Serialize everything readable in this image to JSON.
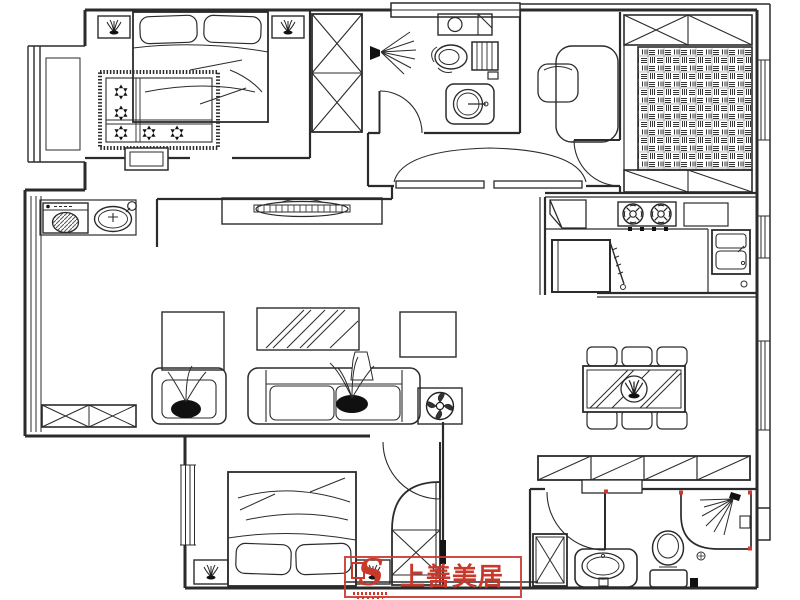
{
  "title": "apartment-floor-plan",
  "watermark": {
    "brand": "上善美居",
    "logo_letter": "S",
    "color": "#c8392c"
  },
  "plan": {
    "background": "#ffffff",
    "line_color": "#2b2b2b",
    "accent_red": "#cf3a30",
    "rooms": [
      {
        "id": "master-bedroom",
        "items": [
          "double-bed",
          "two-pillows",
          "nightstand-with-plant-left",
          "nightstand-with-plant-right",
          "star-pattern-rug",
          "bay-window",
          "dressing-stool",
          "door-opening"
        ]
      },
      {
        "id": "hall-closet",
        "items": [
          "wardrobe-two-x-sections"
        ]
      },
      {
        "id": "bathroom-top",
        "items": [
          "top-window",
          "hand-basin",
          "toilet",
          "round-pedestal-basin",
          "shower-head-spray",
          "swing-door"
        ]
      },
      {
        "id": "entry-foyer",
        "items": [
          "double-entry-door",
          "console-desk",
          "chair"
        ]
      },
      {
        "id": "tatami-room",
        "items": [
          "top-cabinet-x-and-diagonal",
          "woven-mat-floor",
          "bottom-cabinet-diagonals",
          "swing-door",
          "side-window"
        ]
      },
      {
        "id": "kitchen",
        "items": [
          "corner-shelf",
          "gas-stove-two-burners",
          "counter",
          "worktop-box",
          "double-basin-sink",
          "refrigerator-with-open-door",
          "side-window"
        ]
      },
      {
        "id": "dining-room",
        "items": [
          "six-seat-dining-table",
          "striped-table-top",
          "plant-centerpiece",
          "six-chairs",
          "side-window",
          "sideboard-with-diagonals",
          "small-shelf"
        ]
      },
      {
        "id": "living-room",
        "items": [
          "tv-cabinet",
          "television",
          "side-cabinet",
          "area-rug-diagonal-stripes",
          "coffee-table",
          "three-seat-sofa",
          "armchair",
          "decorative-plants",
          "vase",
          "fan-side-table",
          "partition-stub-wall"
        ]
      },
      {
        "id": "laundry-balcony",
        "items": [
          "washing-machine",
          "wash-basin-with-faucet",
          "left-window-band",
          "x-storage-cabinet"
        ]
      },
      {
        "id": "second-bedroom",
        "items": [
          "double-bed",
          "two-pillows",
          "nightstand-with-plant-left",
          "nightstand-with-plant-right",
          "curved-corner-wardrobe",
          "swing-door",
          "left-window-band"
        ]
      },
      {
        "id": "bathroom-bottom",
        "items": [
          "corner-shower-enclosure",
          "red-corner-markers",
          "shower-spray",
          "floor-drain",
          "toilet",
          "vanity-with-oval-basin",
          "x-storage-cabinet",
          "swing-door",
          "door-stop-block"
        ]
      }
    ]
  }
}
